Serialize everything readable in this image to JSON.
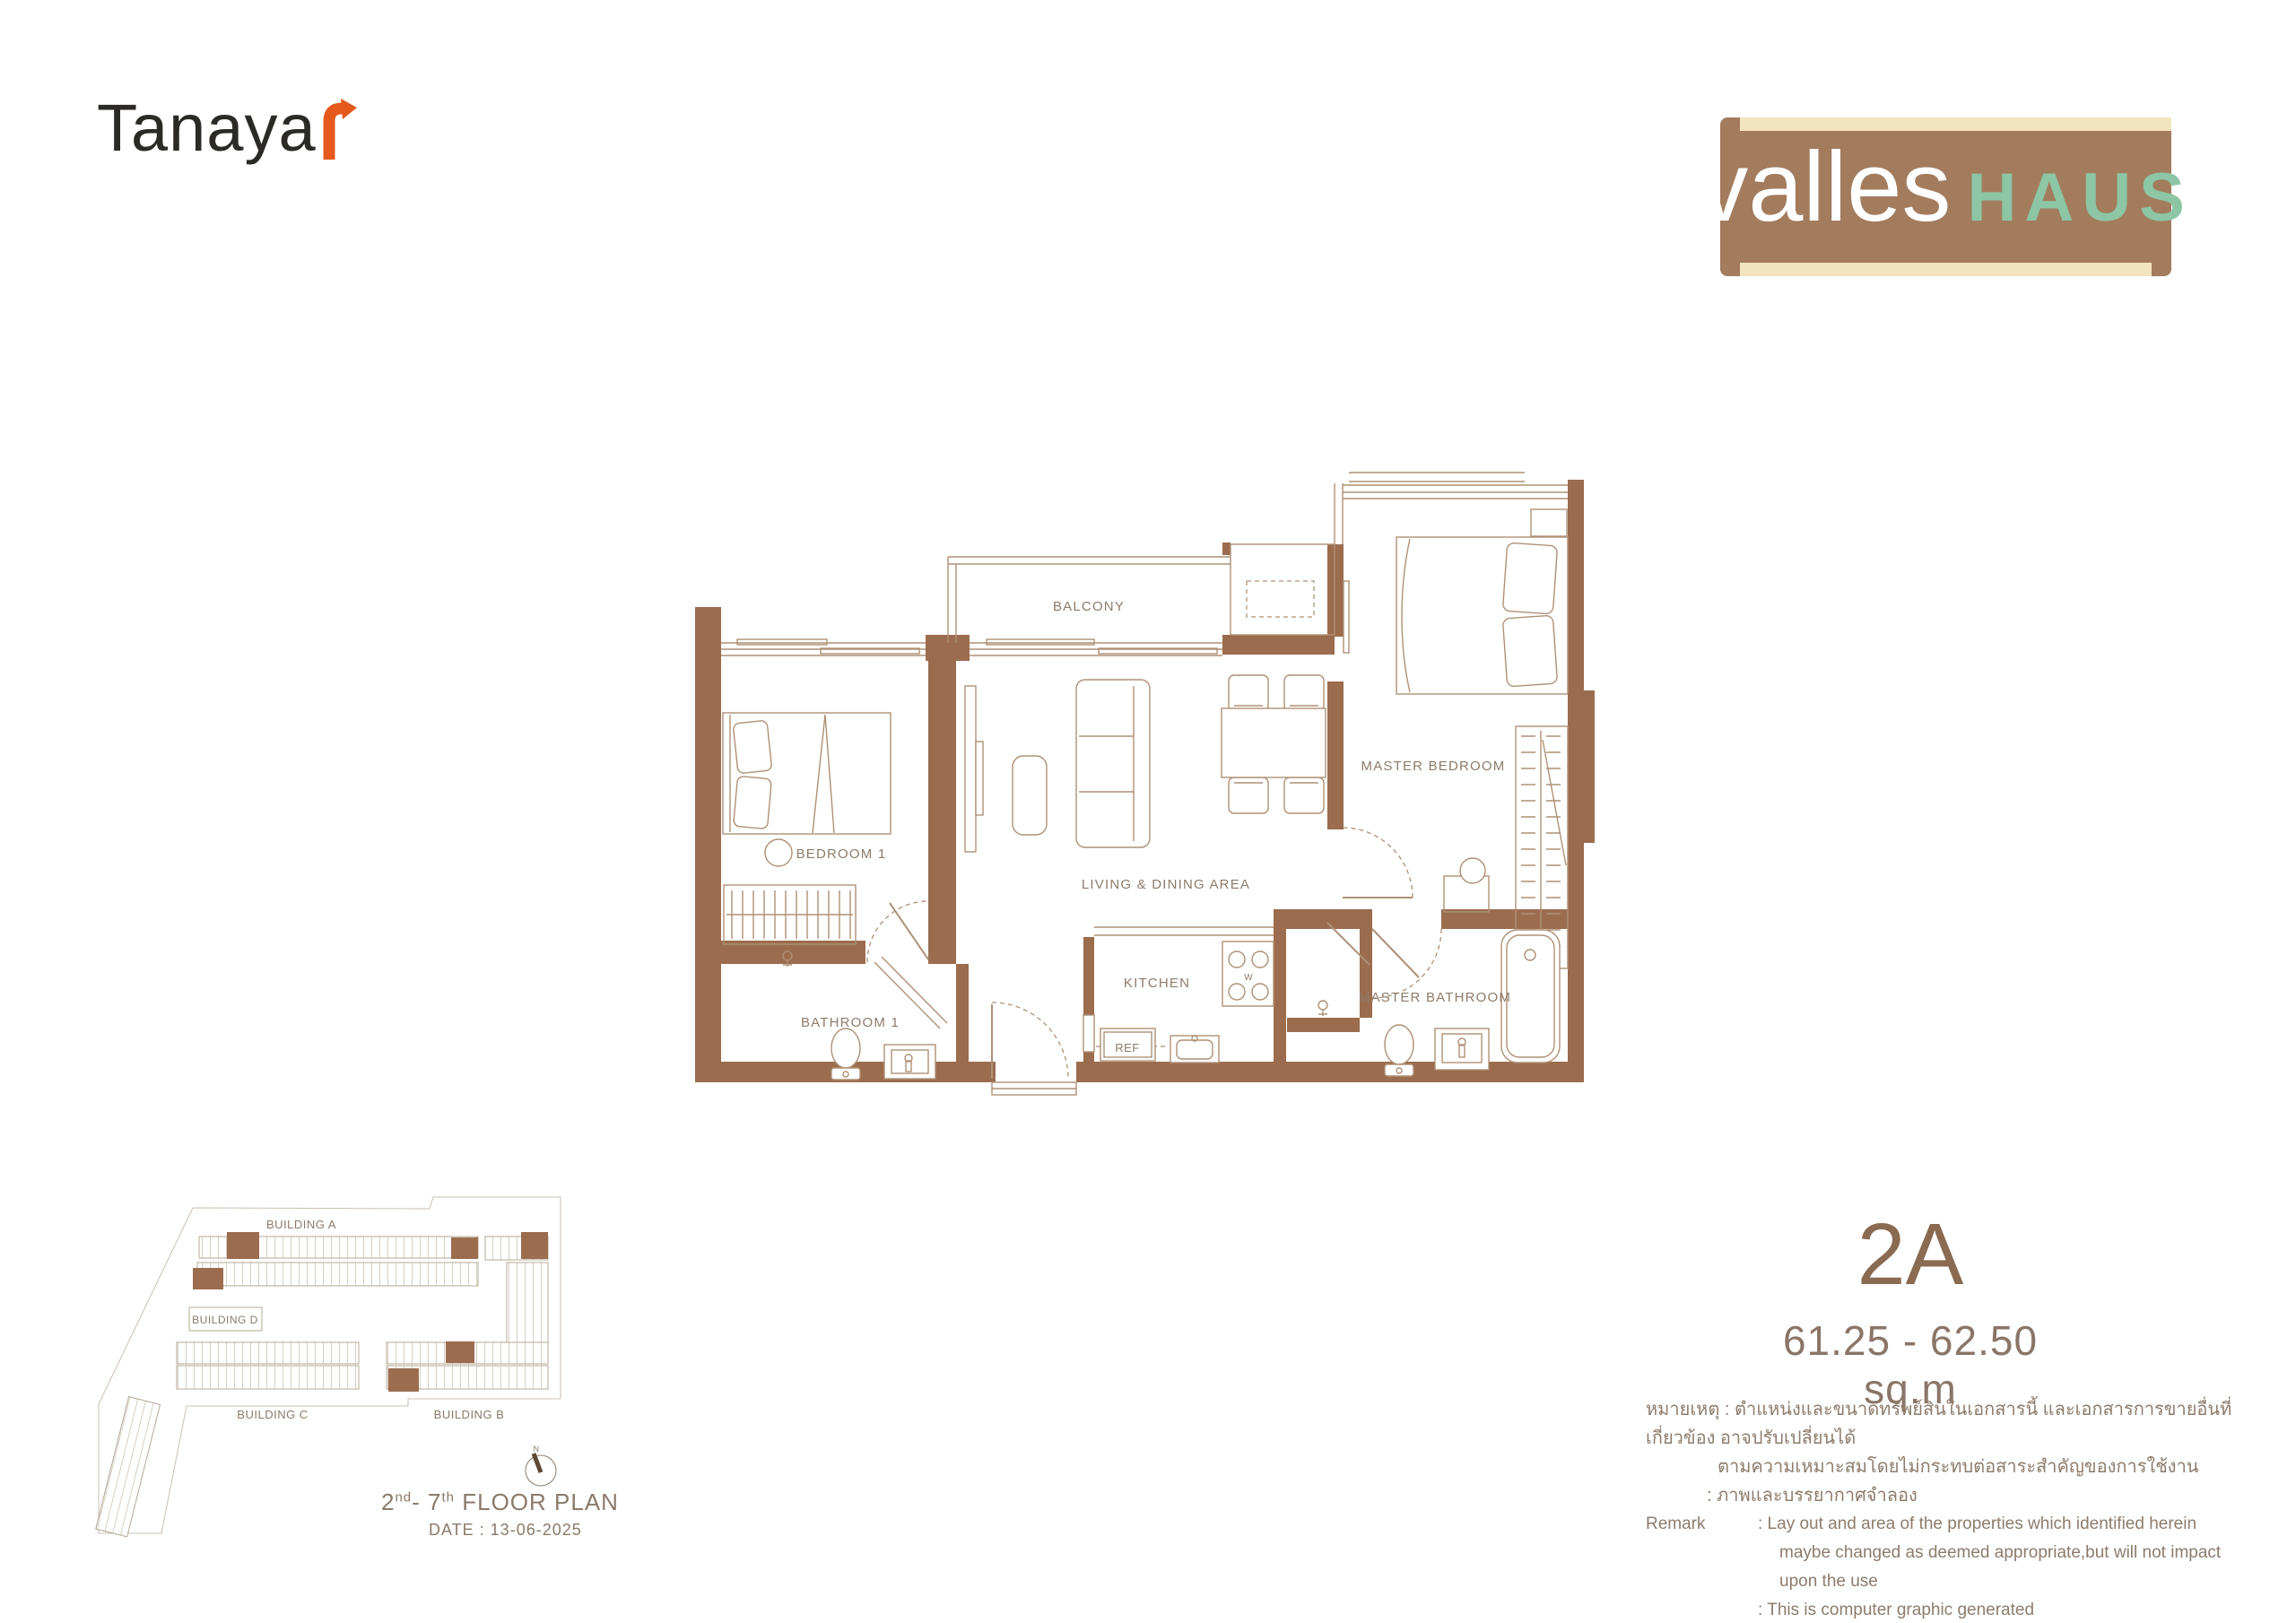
{
  "brand": {
    "developer_wordmark": "Tanaya",
    "developer_arrow_color": "#e5591d",
    "project_word1": "valles",
    "project_word2": "HAUS",
    "badge_brown": "#a37c5e",
    "badge_cream": "#f2e4be",
    "badge_green": "#8cc6a5"
  },
  "unit": {
    "type": "2A",
    "area": "61.25 - 62.50 sq.m"
  },
  "floor_plan": {
    "rooms": {
      "balcony": "BALCONY",
      "bedroom1": "BEDROOM 1",
      "living": "LIVING & DINING AREA",
      "master_bedroom": "MASTER BEDROOM",
      "kitchen": "KITCHEN",
      "ref": "REF",
      "w": "W",
      "bathroom1": "BATHROOM 1",
      "master_bathroom": "MASTER BATHROOM"
    },
    "wall_color": "#9c6c4e",
    "line_color": "#ae9176"
  },
  "site_plan": {
    "buildings": {
      "a": "BUILDING A",
      "b": "BUILDING B",
      "c": "BUILDING C",
      "d": "BUILDING D"
    },
    "compass_n": "N",
    "title_p1": "2",
    "title_sup1": "nd",
    "title_p2": "- 7",
    "title_sup2": "th",
    "title_p3": " FLOOR PLAN",
    "date": "DATE : 13-06-2025"
  },
  "remark": {
    "rows": [
      {
        "label": "",
        "text": "หมายเหตุ : ตำแหน่งและขนาดทรัพย์สินในเอกสารนี้ และเอกสารการขายอื่นที่เกี่ยวข้อง อาจปรับเปลี่ยนได้"
      },
      {
        "label": "",
        "text": "ตามความเหมาะสมโดยไม่กระทบต่อสาระสำคัญของการใช้งาน"
      },
      {
        "label": "",
        "text": ": ภาพและบรรยากาศจำลอง"
      },
      {
        "label": "Remark",
        "text": ": Lay out and area of the properties which identified herein"
      },
      {
        "label": "",
        "text": "maybe changed as deemed appropriate,but will not impact upon the use"
      },
      {
        "label": "",
        "text": ": This is computer graphic generated"
      }
    ]
  }
}
